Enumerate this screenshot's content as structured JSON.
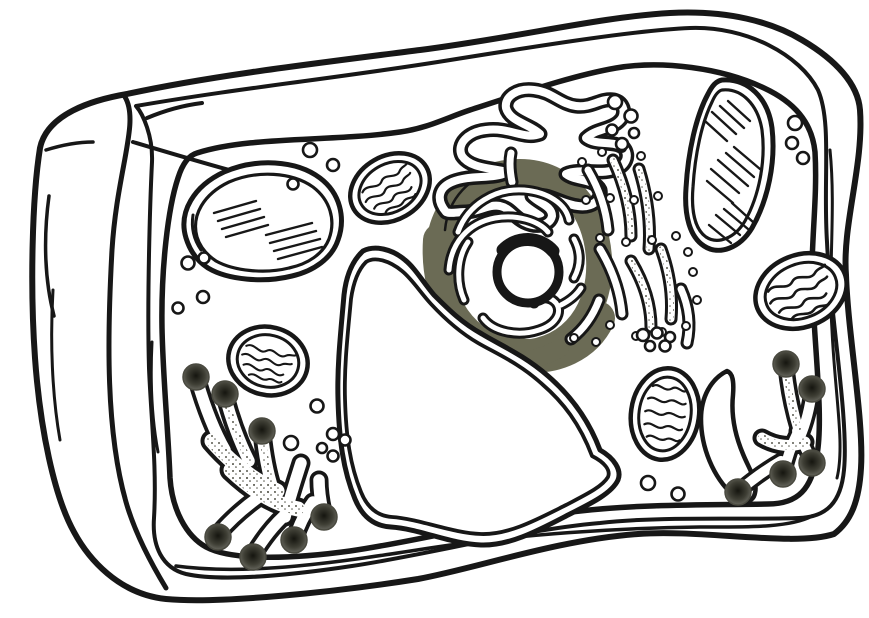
{
  "canvas": {
    "width": 869,
    "height": 618,
    "background": "#ffffff"
  },
  "palette": {
    "ink": "#171717",
    "nucleus_envelope": "#6b6b55",
    "vesicle_center": "#15150f",
    "vesicle_mid": "#3f3f35",
    "vesicle_edge": "#72726a",
    "vesicle_rim": "#4a4a40",
    "stipple_dot": "#5a5a50",
    "paper": "#ffffff"
  },
  "diagram": {
    "type": "line-art biology diagram",
    "subject": "plant cell cross-section, unlabeled coloring-page style, partially colored",
    "colored_regions": [
      {
        "name": "nuclear-envelope",
        "color": "#6b6b55"
      },
      {
        "name": "golgi-secretory-vesicles",
        "color": "#3f3f35"
      }
    ],
    "organelles": [
      {
        "name": "cell-wall",
        "count": 1
      },
      {
        "name": "plasma-membrane",
        "count": 1
      },
      {
        "name": "nucleus-with-nucleolus-and-chromatin",
        "count": 1
      },
      {
        "name": "central-vacuole",
        "count": 1
      },
      {
        "name": "smooth-endoplasmic-reticulum",
        "count": 1
      },
      {
        "name": "rough-endoplasmic-reticulum",
        "count": 1
      },
      {
        "name": "golgi-apparatus",
        "count": 2
      },
      {
        "name": "mitochondrion",
        "count": 4
      },
      {
        "name": "chloroplast",
        "count": 2
      },
      {
        "name": "secretory-vesicle",
        "count": 12
      },
      {
        "name": "free-ribosome-or-vesicle",
        "count": "many"
      }
    ]
  }
}
